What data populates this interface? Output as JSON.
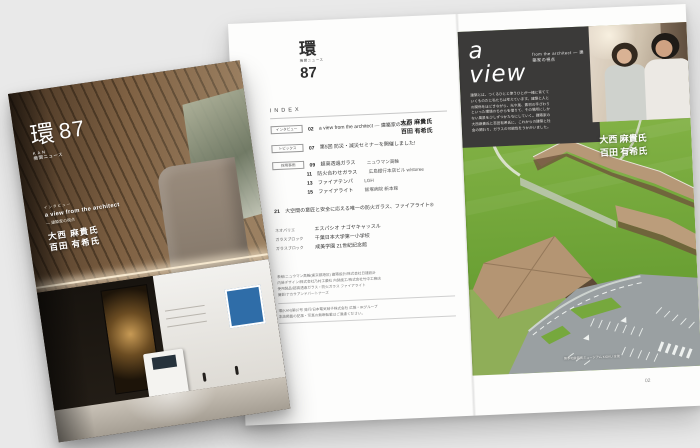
{
  "background_color": "#e9e9e9",
  "cover": {
    "logo_kanji": "環",
    "logo_issue": "87",
    "logo_sub1": "KAN",
    "logo_sub2": "機関ニュース",
    "kicker": "インタビュー",
    "feature_title": "a view from the architect",
    "feature_subtitle": "― 建築家の視点",
    "name1": "大西 麻貴氏",
    "name2": "百田 有希氏"
  },
  "index_page": {
    "logo_kanji": "環",
    "logo_sub": "機関ニュース",
    "logo_issue": "87",
    "index_label": "INDEX",
    "rows": [
      {
        "tag": "インタビュー",
        "num": "02",
        "title": "a view from the architect ― 建築家の視点"
      },
      {
        "tag": "トピックス",
        "num": "07",
        "title": "第5回 防災・減災セミナーを開催しました!"
      },
      {
        "tag": "採用事例",
        "num": "09",
        "title": "超高透過ガラス",
        "extra": "ニュウマン高輪"
      },
      {
        "num": "11",
        "title": "防火合わせガラス",
        "extra": "広島銀行本店ビル w/storee"
      },
      {
        "num": "13",
        "title": "ファイアテンパ",
        "extra": "LGH"
      },
      {
        "num": "15",
        "title": "ファイアライト",
        "extra": "飯塚病院 新本館"
      },
      {
        "num": "21",
        "title": "大空間の意匠と安全に応える唯一の防火ガラス、ファイアライト®"
      },
      {
        "tag2": "ネオパリエ",
        "title": "エスパシオ ナゴヤキャッスル"
      },
      {
        "tag2": "ガラスブロック",
        "title": "千葉日本大学第一小学校"
      },
      {
        "tag2": "ガラスブロック",
        "title": "成美学園 21世紀記念館"
      }
    ],
    "row0_name1": "大西 麻貴氏",
    "row0_name2": "百田 有希氏",
    "credits": [
      "表紙/ニュウマン高輪(東京都港区) 建築設計/株式会社日建設計",
      "内装デザイン/株式会社乃村工藝社 内装施工/株式会社竹中工務店",
      "使用製品/超高透過ガラス・防火ガラス ファイアライト",
      "撮影/ナカサアンドパートナーズ"
    ],
    "colophon": [
      "環(KAN)第87号 発行/日本電気硝子株式会社 広報・IRグループ",
      "本誌掲載の記事・写真の無断転載はご遠慮ください。"
    ]
  },
  "article_page": {
    "title": "a view",
    "subtitle": "from the architect ― 建築家の視点",
    "body_lines": [
      "建築とは、つくるひとと使うひとが一緒に育てて",
      "いくものだと私たちは考えています。建築と人と",
      "の関係をほどきながら、光や風、素材の手ざわり",
      "といった環境のちからを借りて、その場所にしか",
      "ない風景を少しずつかたちにしていく。建築家の",
      "大西麻貴氏と百田有希氏に、これからの建築と社",
      "会の関わり、ガラスの可能性をうかがいました。"
    ],
    "name1": "大西 麻貴氏",
    "name2": "百田 有希氏",
    "caption": "熊本地震震災ミュージアム KIOKU 全景",
    "page_number": "02"
  },
  "colors": {
    "accent_box": "#3b3a39",
    "lawn_green": "#79aa3e",
    "canopy_tan": "#b89878",
    "asphalt_gray": "#9aa0a3"
  }
}
